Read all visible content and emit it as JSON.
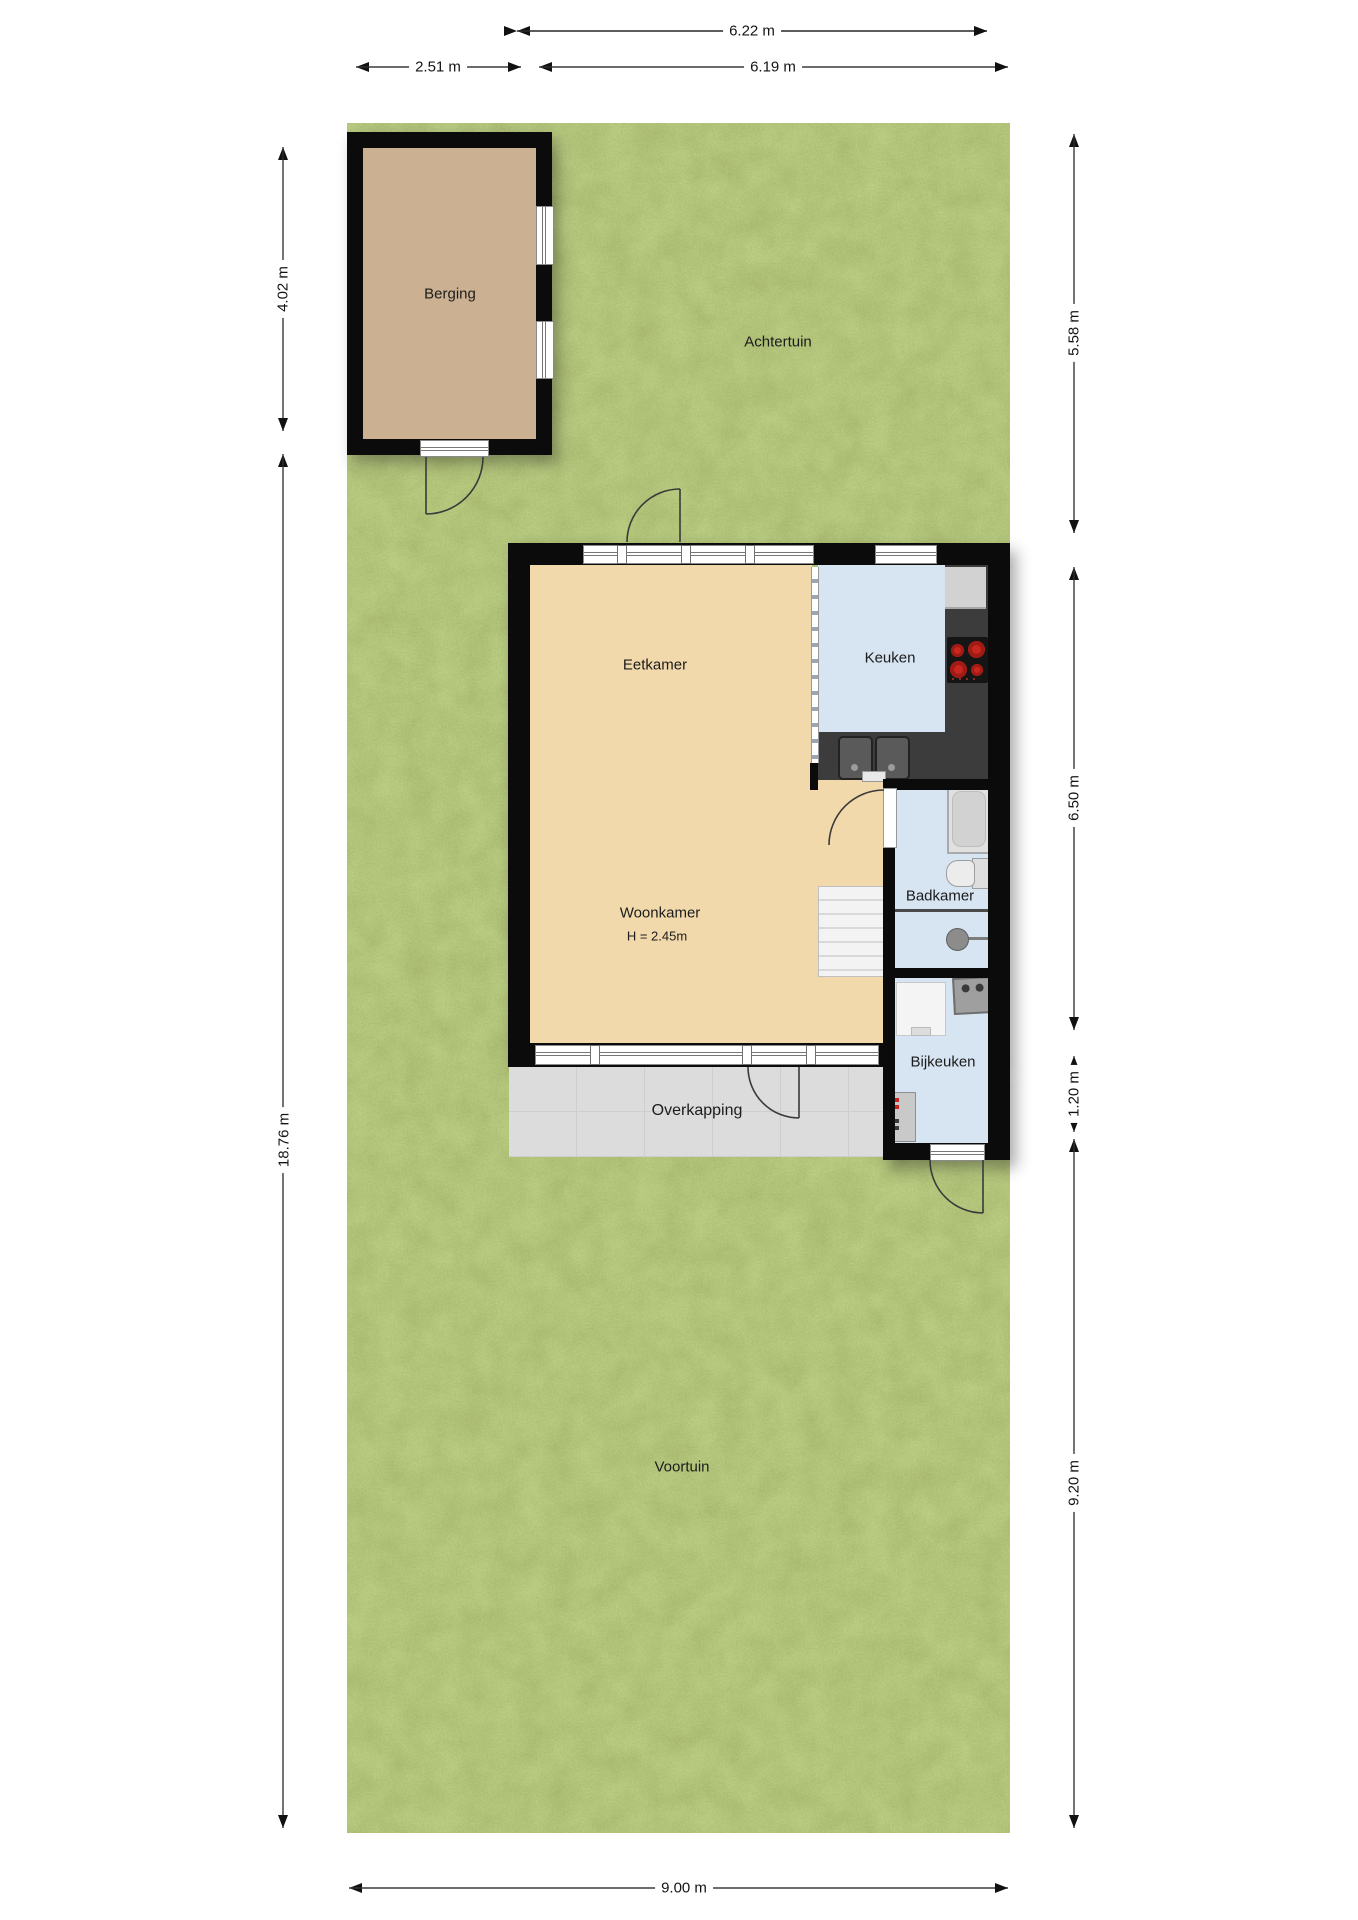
{
  "plan": {
    "rooms": {
      "berging": {
        "label": "Berging"
      },
      "achtertuin": {
        "label": "Achtertuin"
      },
      "eetkamer": {
        "label": "Eetkamer"
      },
      "keuken": {
        "label": "Keuken"
      },
      "woonkamer": {
        "label": "Woonkamer",
        "height_note": "H = 2.45m"
      },
      "badkamer": {
        "label": "Badkamer"
      },
      "bijkeuken": {
        "label": "Bijkeuken"
      },
      "overkapping": {
        "label": "Overkapping"
      },
      "voortuin": {
        "label": "Voortuin"
      }
    },
    "dimensions": {
      "top_total": {
        "label": "6.22 m"
      },
      "top_left": {
        "label": "2.51 m"
      },
      "top_right": {
        "label": "6.19 m"
      },
      "left_upper": {
        "label": "4.02 m"
      },
      "left_total": {
        "label": "18.76 m"
      },
      "right_upper": {
        "label": "5.58 m"
      },
      "right_middle": {
        "label": "6.50 m"
      },
      "right_small": {
        "label": "1.20 m"
      },
      "right_lower": {
        "label": "9.20 m"
      },
      "bottom_total": {
        "label": "9.00 m"
      }
    },
    "colors": {
      "grass": "#7b8f3f",
      "living_floor": "#f2d9ac",
      "wet_room_floor": "#d7e4f2",
      "shed_floor": "#cbb192",
      "counter": "#3c3c3c",
      "terrace": "#dcdcdc",
      "wall": "#0b0b0b",
      "burner_red": "#c8271f"
    }
  }
}
